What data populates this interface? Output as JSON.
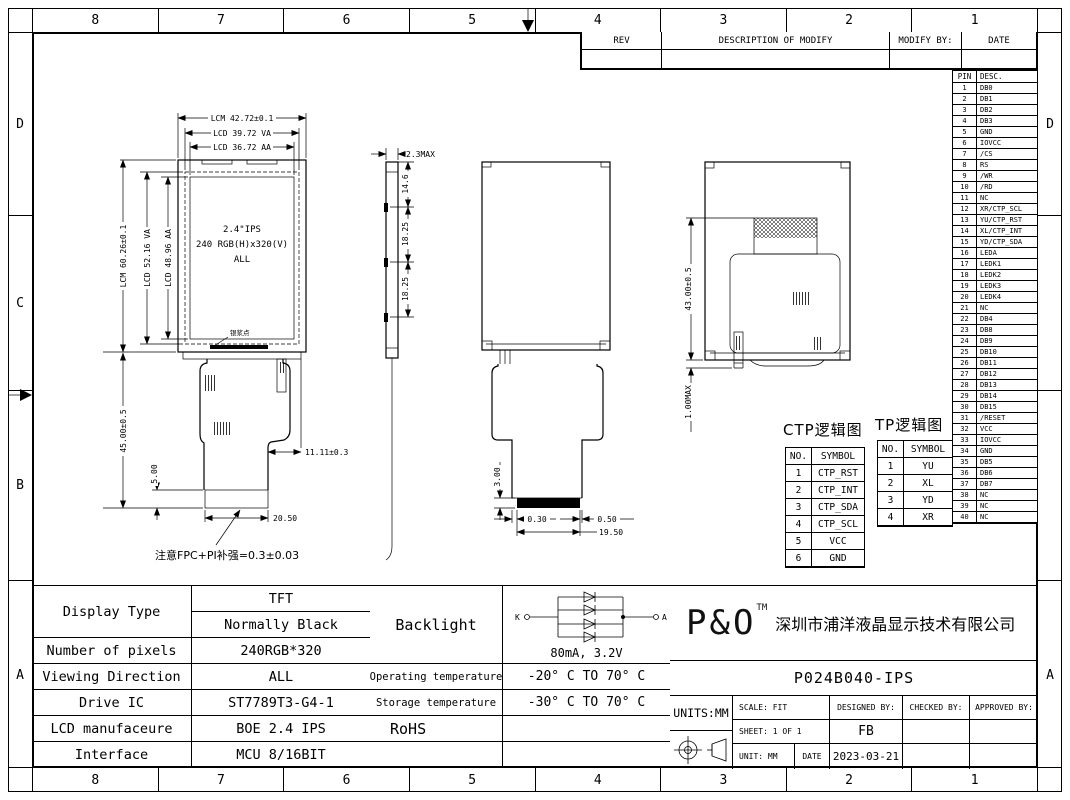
{
  "frame": {
    "columns": [
      "8",
      "7",
      "6",
      "5",
      "4",
      "3",
      "2",
      "1"
    ],
    "rows_left": [
      "D",
      "C",
      "B",
      "A"
    ],
    "rows_right": [
      "D",
      "",
      "",
      "A"
    ]
  },
  "rev_table": {
    "rev": "REV",
    "description": "DESCRIPTION OF MODIFY",
    "modify_by": "MODIFY BY:",
    "date": "DATE"
  },
  "pin_table": {
    "pin_header": "PIN",
    "desc_header": "DESC.",
    "rows": [
      {
        "pin": "1",
        "desc": "DB0"
      },
      {
        "pin": "2",
        "desc": "DB1"
      },
      {
        "pin": "3",
        "desc": "DB2"
      },
      {
        "pin": "4",
        "desc": "DB3"
      },
      {
        "pin": "5",
        "desc": "GND"
      },
      {
        "pin": "6",
        "desc": "IOVCC"
      },
      {
        "pin": "7",
        "desc": "/CS"
      },
      {
        "pin": "8",
        "desc": "RS"
      },
      {
        "pin": "9",
        "desc": "/WR"
      },
      {
        "pin": "10",
        "desc": "/RD"
      },
      {
        "pin": "11",
        "desc": "NC"
      },
      {
        "pin": "12",
        "desc": "XR/CTP_SCL"
      },
      {
        "pin": "13",
        "desc": "YU/CTP_RST"
      },
      {
        "pin": "14",
        "desc": "XL/CTP_INT"
      },
      {
        "pin": "15",
        "desc": "YD/CTP_SDA"
      },
      {
        "pin": "16",
        "desc": "LEDA"
      },
      {
        "pin": "17",
        "desc": "LEDK1"
      },
      {
        "pin": "18",
        "desc": "LEDK2"
      },
      {
        "pin": "19",
        "desc": "LEDK3"
      },
      {
        "pin": "20",
        "desc": "LEDK4"
      },
      {
        "pin": "21",
        "desc": "NC"
      },
      {
        "pin": "22",
        "desc": "DB4"
      },
      {
        "pin": "23",
        "desc": "DB8"
      },
      {
        "pin": "24",
        "desc": "DB9"
      },
      {
        "pin": "25",
        "desc": "DB10"
      },
      {
        "pin": "26",
        "desc": "DB11"
      },
      {
        "pin": "27",
        "desc": "DB12"
      },
      {
        "pin": "28",
        "desc": "DB13"
      },
      {
        "pin": "29",
        "desc": "DB14"
      },
      {
        "pin": "30",
        "desc": "DB15"
      },
      {
        "pin": "31",
        "desc": "/RESET"
      },
      {
        "pin": "32",
        "desc": "VCC"
      },
      {
        "pin": "33",
        "desc": "IOVCC"
      },
      {
        "pin": "34",
        "desc": "GND"
      },
      {
        "pin": "35",
        "desc": "DB5"
      },
      {
        "pin": "36",
        "desc": "DB6"
      },
      {
        "pin": "37",
        "desc": "DB7"
      },
      {
        "pin": "38",
        "desc": "NC"
      },
      {
        "pin": "39",
        "desc": "NC"
      },
      {
        "pin": "40",
        "desc": "NC"
      }
    ]
  },
  "ctp_table": {
    "title": "CTP逻辑图",
    "no_header": "NO.",
    "symbol_header": "SYMBOL",
    "rows": [
      {
        "no": "1",
        "symbol": "CTP_RST"
      },
      {
        "no": "2",
        "symbol": "CTP_INT"
      },
      {
        "no": "3",
        "symbol": "CTP_SDA"
      },
      {
        "no": "4",
        "symbol": "CTP_SCL"
      },
      {
        "no": "5",
        "symbol": "VCC"
      },
      {
        "no": "6",
        "symbol": "GND"
      }
    ]
  },
  "tp_table": {
    "title": "TP逻辑图",
    "no_header": "NO.",
    "symbol_header": "SYMBOL",
    "rows": [
      {
        "no": "1",
        "symbol": "YU"
      },
      {
        "no": "2",
        "symbol": "XL"
      },
      {
        "no": "3",
        "symbol": "YD"
      },
      {
        "no": "4",
        "symbol": "XR"
      }
    ]
  },
  "front_view": {
    "screen_line1": "2.4\"IPS",
    "screen_line2": "240 RGB(H)x320(V)",
    "screen_line3": "ALL",
    "dim_top_lcm": "LCM 42.72±0.1",
    "dim_top_va": "LCD 39.72 VA",
    "dim_top_aa": "LCD 36.72 AA",
    "dim_left_lcm": "LCM 60.26±0.1",
    "dim_left_va": "LCD 52.16 VA",
    "dim_left_aa": "LCD 48.96 AA",
    "dim_fpc_height": "45.00±0.5",
    "dim_stiffener": "5.00",
    "dim_fpc_width": "11.11±0.3",
    "dim_connector": "20.50",
    "paste_label": "银浆点",
    "note": "注意FPC+PI补强=0.3±0.03"
  },
  "side_view": {
    "dim_thickness": "2.3MAX",
    "dim_seg1": "14.6",
    "dim_seg2": "18.25",
    "dim_seg3": "18.25"
  },
  "back_view": {
    "dim_conn_h": "3.00",
    "dim_left_off": "0.30",
    "dim_right_off": "0.50",
    "dim_conn_w": "19.50"
  },
  "rear_view": {
    "dim_height": "43.00±0.5",
    "dim_gap": "1.00MAX"
  },
  "spec_table": {
    "display_type_label": "Display Type",
    "display_type_v1": "TFT",
    "display_type_v2": "Normally Black",
    "pixels_label": "Number of pixels",
    "pixels_value": "240RGB*320",
    "viewing_label": "Viewing Direction",
    "viewing_value": "ALL",
    "ic_label": "Drive IC",
    "ic_value": "ST7789T3-G4-1",
    "mfr_label": "LCD manufaceure",
    "mfr_value": "BOE 2.4 IPS",
    "iface_label": "Interface",
    "iface_value": "MCU 8/16BIT"
  },
  "env_table": {
    "backlight_label": "Backlight",
    "backlight_rating": "80mA, 3.2V",
    "k": "K",
    "a": "A",
    "op_label": "Operating temperature",
    "op_value": "-20° C TO 70° C",
    "st_label": "Storage temperature",
    "st_value": "-30° C TO 70° C",
    "rohs_label": "RoHS"
  },
  "title_block": {
    "logo": "P&O",
    "tm": "TM",
    "company": "深圳市浦洋液晶显示技术有限公司",
    "part_number": "P024B040-IPS",
    "units": "UNITS:MM",
    "scale": "SCALE:  FIT",
    "designed": "DESIGNED BY:",
    "checked": "CHECKED BY:",
    "approved": "APPROVED BY:",
    "sheet": "SHEET:  1 OF 1",
    "designer": "FB",
    "unit": "UNIT:  MM",
    "date_label": "DATE",
    "date": "2023-03-21"
  }
}
